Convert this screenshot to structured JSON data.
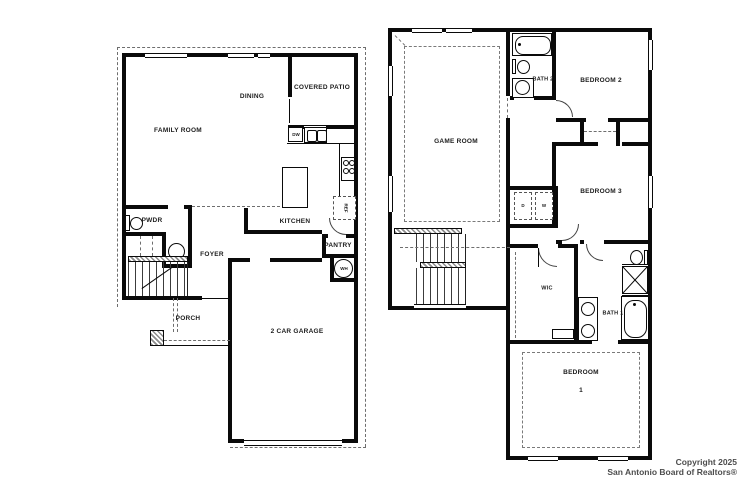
{
  "floors": {
    "first": {
      "labels": {
        "family_room": "FAMILY ROOM",
        "dining": "DINING",
        "covered_patio": "COVERED PATIO",
        "kitchen": "KITCHEN",
        "pwdr": "PWDR",
        "foyer": "FOYER",
        "pantry": "PANTRY",
        "porch": "PORCH",
        "garage": "2 CAR GARAGE"
      },
      "fixtures": {
        "dishwasher": "DW",
        "refrigerator": "REF",
        "water_heater": "WH"
      }
    },
    "second": {
      "labels": {
        "game_room": "GAME ROOM",
        "bath_2": "BATH 2",
        "bedroom_2": "BEDROOM 2",
        "bedroom_3": "BEDROOM 3",
        "wic": "WIC",
        "bath_1": "BATH 1",
        "bedroom_1_line1": "BEDROOM",
        "bedroom_1_line2": "1"
      },
      "fixtures": {
        "dryer": "D",
        "washer": "W"
      }
    }
  },
  "footer": {
    "copyright_line1": "Copyright 2025",
    "copyright_line2": "San Antonio Board of Realtors®"
  },
  "colors": {
    "wall": "#0a0a0a",
    "background": "#ffffff",
    "dashed_line": "#6e6e6e",
    "footer_text": "#4d4d4d"
  }
}
